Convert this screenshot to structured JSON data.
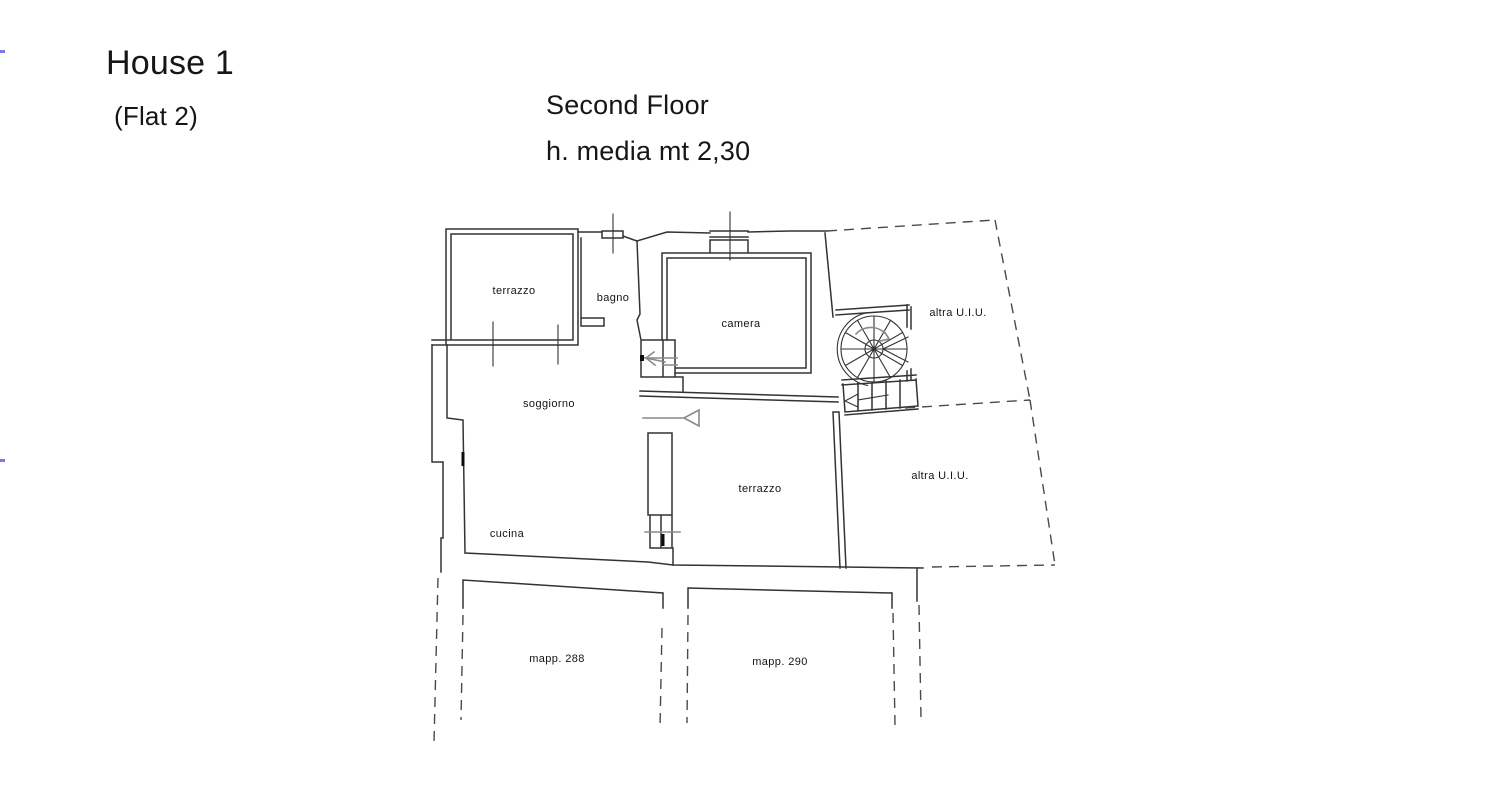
{
  "page": {
    "title": "House 1",
    "subtitle": "(Flat 2)",
    "floor_label": "Second Floor",
    "height_note": "h. media mt 2,30"
  },
  "floor_plan": {
    "labels": {
      "terrazzo_top": "terrazzo",
      "bagno": "bagno",
      "camera": "camera",
      "soggiorno": "soggiorno",
      "cucina": "cucina",
      "terrazzo_mid": "terrazzo",
      "altra_uiu_upper": "altra U.I.U.",
      "altra_uiu_lower": "altra U.I.U.",
      "mapp_288": "mapp. 288",
      "mapp_290": "mapp. 290"
    },
    "features": {
      "spiral_staircase": "spiral-staircase",
      "straight_stair": "straight-stair-flight",
      "entry_arrow": "entrance-direction-arrow"
    },
    "colors": {
      "wall": "#333333",
      "secondary": "#8a8a8a",
      "dashed": "#4a4a4a",
      "label": "#141414",
      "edge_mark": "#7b7be0",
      "background": "#ffffff"
    }
  }
}
